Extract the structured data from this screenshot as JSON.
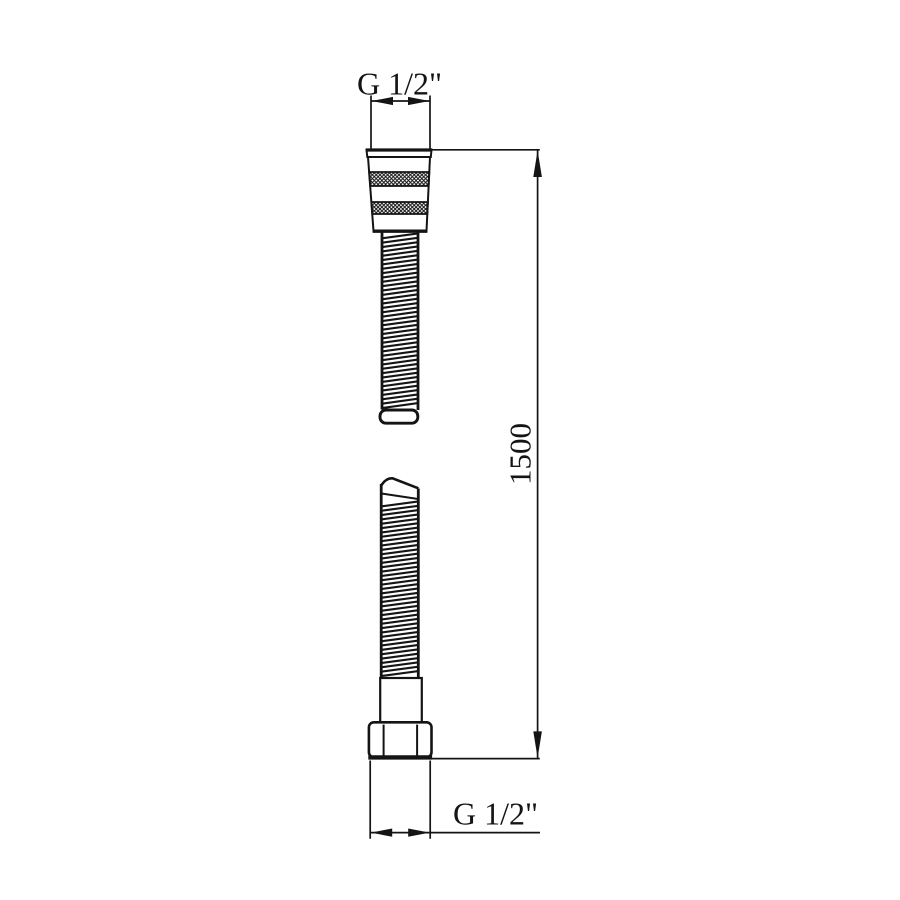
{
  "drawing": {
    "title": "Shower hose dimensional drawing",
    "top_thread_label": "G 1/2\"",
    "bottom_thread_label": "G 1/2\"",
    "length_label": "1500",
    "line_color": "#141414",
    "background_color": "#ffffff"
  }
}
